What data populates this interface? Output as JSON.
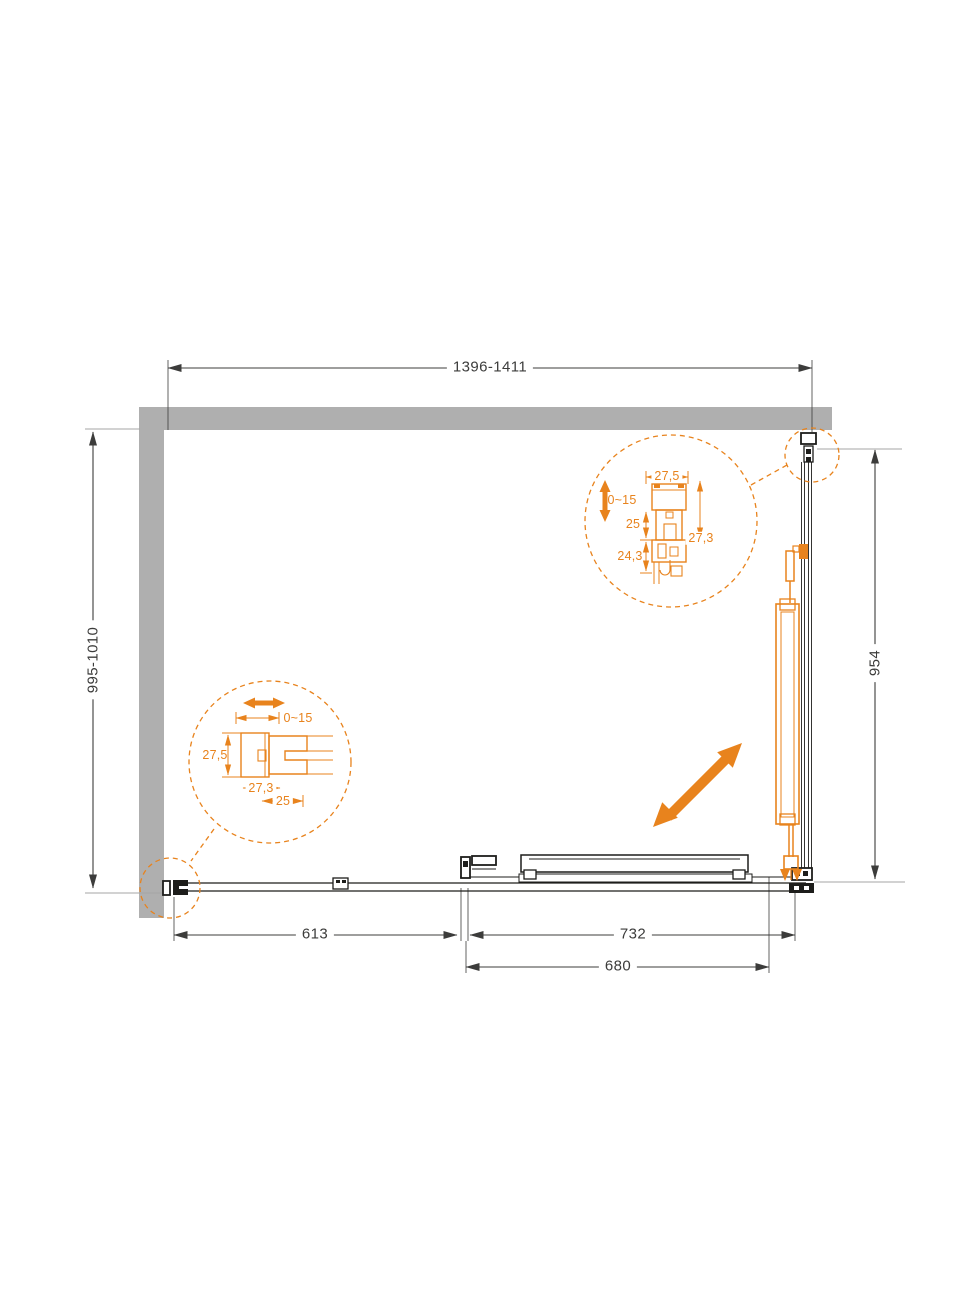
{
  "title": "Shower enclosure plan drawing",
  "colors": {
    "accent_orange": "#E8831D",
    "wall_gray": "#AFAFAF",
    "line_black": "#1D1D1B",
    "dim_gray": "#3C3C3B",
    "ext_light": "#A6A6A6"
  },
  "dimensions": {
    "width_overall": "1396-1411",
    "depth_overall": "995-1010",
    "side_panel_depth": "954",
    "fixed_section": "613",
    "front_section": "732",
    "door_opening": "680"
  },
  "detail_top_right": {
    "profile_width": "27,5",
    "adjust_range": "0~15",
    "inner_offset": "25",
    "lower_depth": "24,3",
    "side_depth": "27,3"
  },
  "detail_bottom_left": {
    "adjust_range": "0~15",
    "profile_height": "27,5",
    "profile_depth": "27,3",
    "inner_offset": "25"
  },
  "icons": {
    "open_direction": "diagonal-double-arrow",
    "horizontal_adjust": "horizontal-double-arrow",
    "vertical_adjust": "vertical-double-arrow"
  }
}
